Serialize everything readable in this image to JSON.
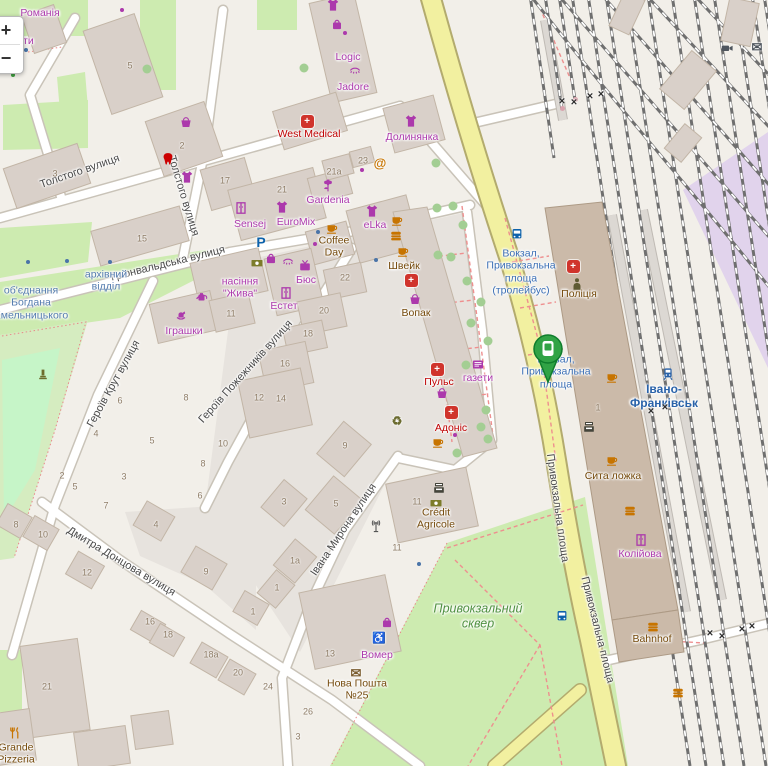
{
  "app": {
    "title": "OpenStreetMap city map — railway station area"
  },
  "controls": {
    "zoom_in": "+",
    "zoom_out": "−"
  },
  "marker": {
    "name": "selected-transit-stop",
    "color": "#31a345"
  },
  "map": {
    "streets": [
      {
        "t": "Толстого вулиця",
        "x": 80,
        "y": 172,
        "r": -19,
        "n": "street-tolstoho"
      },
      {
        "t": "Толстого вулиця",
        "x": 183,
        "y": 196,
        "r": 73,
        "n": "street-tolstoho-2"
      },
      {
        "t": "Грюнвальдська вулиця",
        "x": 168,
        "y": 264,
        "r": -14,
        "n": "street-hriunvaldska"
      },
      {
        "t": "Героїв Крут вулиця",
        "x": 114,
        "y": 384,
        "r": -61,
        "n": "street-heroiv-krut"
      },
      {
        "t": "Героїв Пожежників вулиця",
        "x": 246,
        "y": 372,
        "r": -48,
        "n": "street-heroiv-pozhezhnykiv"
      },
      {
        "t": "Дмитра Донцова вулиця",
        "x": 121,
        "y": 562,
        "r": 31,
        "n": "street-dmytra-dontsova"
      },
      {
        "t": "Івана Мирона вулиця",
        "x": 344,
        "y": 530,
        "r": -56,
        "n": "street-ivana-myrona"
      },
      {
        "t": "Привокзальна площа",
        "x": 557,
        "y": 508,
        "r": 82,
        "n": "street-pryvokzalna-1"
      },
      {
        "t": "Привокзальна площа",
        "x": 597,
        "y": 630,
        "r": 76,
        "n": "street-pryvokzalna-2"
      }
    ],
    "stops": [
      {
        "t": "Вокзал,\nПривокзальна\nплоща\n(тролейбус)",
        "x": 521,
        "y": 272,
        "k": "stop",
        "n": "stop-vokzal-trolleybus"
      },
      {
        "t": "Вокзал,\nПривокзальна\nплоща",
        "x": 556,
        "y": 372,
        "k": "stop",
        "n": "stop-vokzal-square"
      },
      {
        "t": "об'єднання\nБогдана\nХмельницького",
        "x": 31,
        "y": 303,
        "k": "busstop",
        "n": "stop-obiednannia"
      },
      {
        "t": "архівний\nвідділ",
        "x": 106,
        "y": 281,
        "k": "busstop",
        "n": "stop-arkhivnyi-viddil"
      },
      {
        "t": "Івано-\nФранківськ",
        "x": 664,
        "y": 396,
        "k": "station",
        "n": "station-ivano-frankivsk"
      }
    ],
    "pois": [
      {
        "t": "Романія",
        "x": 40,
        "y": 13,
        "k": "shop",
        "n": "poi-romaniia"
      },
      {
        "t": "кти",
        "x": 26,
        "y": 41,
        "k": "shop",
        "n": "poi-produkty-fragment"
      },
      {
        "t": "Logic",
        "x": 348,
        "y": 57,
        "k": "shop",
        "n": "poi-logic"
      },
      {
        "t": "Jadore",
        "x": 353,
        "y": 87,
        "k": "shop",
        "n": "poi-jadore"
      },
      {
        "t": "Долинянка",
        "x": 412,
        "y": 137,
        "k": "shop",
        "n": "poi-dolynianka"
      },
      {
        "t": "Sensej",
        "x": 250,
        "y": 224,
        "k": "shop",
        "n": "poi-sensej"
      },
      {
        "t": "EuroMix",
        "x": 296,
        "y": 222,
        "k": "shop",
        "n": "poi-euromix"
      },
      {
        "t": "Gardenia",
        "x": 328,
        "y": 200,
        "k": "shop",
        "n": "poi-gardenia"
      },
      {
        "t": "eLka",
        "x": 375,
        "y": 225,
        "k": "shop",
        "n": "poi-elka"
      },
      {
        "t": "насіння\n\"Жива\"",
        "x": 240,
        "y": 288,
        "k": "shop",
        "n": "poi-nasinnia-zhyva"
      },
      {
        "t": "Бюс",
        "x": 306,
        "y": 280,
        "k": "shop",
        "n": "poi-bius"
      },
      {
        "t": "Естет",
        "x": 284,
        "y": 306,
        "k": "shop",
        "n": "poi-estet"
      },
      {
        "t": "Іграшки",
        "x": 184,
        "y": 331,
        "k": "shop",
        "n": "poi-ihrashky"
      },
      {
        "t": "газети",
        "x": 478,
        "y": 378,
        "k": "shop",
        "n": "poi-hazety"
      },
      {
        "t": "Колійова",
        "x": 640,
        "y": 554,
        "k": "shop",
        "n": "poi-koliiova"
      },
      {
        "t": "Вомер",
        "x": 377,
        "y": 655,
        "k": "shop",
        "n": "poi-vomer"
      },
      {
        "t": "Coffee\nDay",
        "x": 334,
        "y": 247,
        "k": "amenity",
        "n": "poi-coffee-day"
      },
      {
        "t": "Швейк",
        "x": 404,
        "y": 266,
        "k": "amenity",
        "n": "poi-shveik"
      },
      {
        "t": "Вопак",
        "x": 416,
        "y": 313,
        "k": "amenity",
        "n": "poi-vopak"
      },
      {
        "t": "Поліція",
        "x": 579,
        "y": 294,
        "k": "amenity",
        "n": "poi-politsiia"
      },
      {
        "t": "Сита ложка",
        "x": 613,
        "y": 476,
        "k": "amenity",
        "n": "poi-syta-lozhka"
      },
      {
        "t": "Bahnhof",
        "x": 652,
        "y": 639,
        "k": "amenity",
        "n": "poi-bahnhof"
      },
      {
        "t": "Crédit\nAgricole",
        "x": 436,
        "y": 519,
        "k": "amenity",
        "n": "poi-credit-agricole"
      },
      {
        "t": "Нова Пошта\n№25",
        "x": 357,
        "y": 690,
        "k": "amenity",
        "n": "poi-nova-poshta-25"
      },
      {
        "t": "Grande\nPizzeria",
        "x": 16,
        "y": 754,
        "k": "amenity",
        "n": "poi-grande-pizzeria"
      },
      {
        "t": "West Medical",
        "x": 309,
        "y": 134,
        "k": "health",
        "n": "poi-west-medical"
      },
      {
        "t": "Пульс",
        "x": 439,
        "y": 382,
        "k": "health",
        "n": "poi-puls"
      },
      {
        "t": "Адоніс",
        "x": 451,
        "y": 428,
        "k": "health",
        "n": "poi-adonis"
      },
      {
        "t": "Привокзальний\nсквер",
        "x": 478,
        "y": 616,
        "k": "parklbl",
        "n": "area-pryvokzalnyi-skver"
      }
    ],
    "housenumbers": [
      {
        "t": "5",
        "x": 130,
        "y": 66
      },
      {
        "t": "3",
        "x": 55,
        "y": 174
      },
      {
        "t": "2",
        "x": 182,
        "y": 146
      },
      {
        "t": "17",
        "x": 225,
        "y": 181
      },
      {
        "t": "15",
        "x": 142,
        "y": 239
      },
      {
        "t": "21",
        "x": 282,
        "y": 190
      },
      {
        "t": "21a",
        "x": 334,
        "y": 172
      },
      {
        "t": "23",
        "x": 363,
        "y": 161
      },
      {
        "t": "22",
        "x": 345,
        "y": 278
      },
      {
        "t": "20",
        "x": 324,
        "y": 311
      },
      {
        "t": "18",
        "x": 308,
        "y": 334
      },
      {
        "t": "16",
        "x": 285,
        "y": 364
      },
      {
        "t": "14",
        "x": 281,
        "y": 399
      },
      {
        "t": "12",
        "x": 259,
        "y": 398
      },
      {
        "t": "11",
        "x": 231,
        "y": 314
      },
      {
        "t": "8",
        "x": 186,
        "y": 398
      },
      {
        "t": "6",
        "x": 120,
        "y": 401
      },
      {
        "t": "5",
        "x": 152,
        "y": 441
      },
      {
        "t": "4",
        "x": 96,
        "y": 434
      },
      {
        "t": "10",
        "x": 223,
        "y": 444
      },
      {
        "t": "8",
        "x": 203,
        "y": 464
      },
      {
        "t": "3",
        "x": 124,
        "y": 477
      },
      {
        "t": "2",
        "x": 62,
        "y": 476
      },
      {
        "t": "5",
        "x": 75,
        "y": 487
      },
      {
        "t": "6",
        "x": 200,
        "y": 496
      },
      {
        "t": "7",
        "x": 106,
        "y": 506
      },
      {
        "t": "9",
        "x": 345,
        "y": 446
      },
      {
        "t": "3",
        "x": 284,
        "y": 502
      },
      {
        "t": "5",
        "x": 336,
        "y": 504
      },
      {
        "t": "1a",
        "x": 295,
        "y": 561
      },
      {
        "t": "1",
        "x": 277,
        "y": 588
      },
      {
        "t": "11",
        "x": 417,
        "y": 502
      },
      {
        "t": "11",
        "x": 397,
        "y": 548
      },
      {
        "t": "13",
        "x": 330,
        "y": 654
      },
      {
        "t": "24",
        "x": 268,
        "y": 687
      },
      {
        "t": "26",
        "x": 308,
        "y": 712
      },
      {
        "t": "3",
        "x": 298,
        "y": 737
      },
      {
        "t": "8",
        "x": 16,
        "y": 525
      },
      {
        "t": "10",
        "x": 43,
        "y": 535
      },
      {
        "t": "12",
        "x": 87,
        "y": 573
      },
      {
        "t": "4",
        "x": 156,
        "y": 525
      },
      {
        "t": "9",
        "x": 206,
        "y": 572
      },
      {
        "t": "1",
        "x": 253,
        "y": 612
      },
      {
        "t": "16",
        "x": 150,
        "y": 622
      },
      {
        "t": "18",
        "x": 168,
        "y": 635
      },
      {
        "t": "18a",
        "x": 211,
        "y": 655
      },
      {
        "t": "20",
        "x": 238,
        "y": 673
      },
      {
        "t": "21",
        "x": 47,
        "y": 687
      },
      {
        "t": "1",
        "x": 598,
        "y": 408
      }
    ],
    "icons": [
      {
        "s": "bus",
        "x": 517,
        "y": 234,
        "c": "#0d62ab",
        "n": "bus-stop-icon"
      },
      {
        "s": "bus",
        "x": 562,
        "y": 616,
        "c": "#0d62ab",
        "n": "bus-stop-icon"
      },
      {
        "s": "train",
        "x": 668,
        "y": 374,
        "c": "#2962a9",
        "n": "railway-station-icon"
      },
      {
        "ch": "P",
        "x": 261,
        "y": 242,
        "c": "#0d62ab",
        "fs": 14,
        "n": "parking-icon"
      },
      {
        "s": "tshirt",
        "x": 411,
        "y": 121,
        "c": "#ac39ac",
        "n": "clothes-shop-icon"
      },
      {
        "s": "tshirt",
        "x": 282,
        "y": 207,
        "c": "#ac39ac",
        "n": "clothes-shop-icon"
      },
      {
        "s": "tshirt",
        "x": 372,
        "y": 211,
        "c": "#ac39ac",
        "n": "clothes-shop-icon"
      },
      {
        "s": "tshirt",
        "x": 333,
        "y": 5,
        "c": "#ac39ac",
        "n": "clothes-shop-icon"
      },
      {
        "s": "tshirt",
        "x": 187,
        "y": 177,
        "c": "#ac39ac",
        "n": "clothes-shop-icon"
      },
      {
        "s": "wardrobe",
        "x": 241,
        "y": 208,
        "c": "#ac39ac",
        "n": "furniture-shop-icon"
      },
      {
        "s": "wardrobe",
        "x": 641,
        "y": 540,
        "c": "#ac39ac",
        "n": "furniture-shop-icon"
      },
      {
        "s": "wardrobe",
        "x": 286,
        "y": 293,
        "c": "#ac39ac",
        "n": "furniture-shop-icon"
      },
      {
        "s": "flower",
        "x": 328,
        "y": 186,
        "c": "#ac39ac",
        "n": "florist-icon"
      },
      {
        "s": "basket",
        "x": 186,
        "y": 122,
        "c": "#ac39ac",
        "n": "supermarket-icon"
      },
      {
        "s": "basket",
        "x": 415,
        "y": 299,
        "c": "#ac39ac",
        "n": "supermarket-icon"
      },
      {
        "s": "basket",
        "x": 442,
        "y": 393,
        "c": "#ac39ac",
        "n": "supermarket-icon"
      },
      {
        "s": "tv",
        "x": 305,
        "y": 266,
        "c": "#ac39ac",
        "n": "electronics-shop-icon"
      },
      {
        "s": "can",
        "x": 202,
        "y": 296,
        "c": "#ac39ac",
        "n": "garden-shop-icon"
      },
      {
        "s": "news",
        "x": 478,
        "y": 364,
        "c": "#ac39ac",
        "n": "newsagent-icon"
      },
      {
        "s": "bag",
        "x": 271,
        "y": 258,
        "c": "#ac39ac",
        "n": "bag-shop-icon"
      },
      {
        "s": "bag",
        "x": 337,
        "y": 24,
        "c": "#ac39ac",
        "n": "bag-shop-icon"
      },
      {
        "s": "bag",
        "x": 387,
        "y": 622,
        "c": "#ac39ac",
        "n": "bag-shop-icon"
      },
      {
        "s": "lash",
        "x": 288,
        "y": 261,
        "c": "#ac39ac",
        "n": "beauty-shop-icon"
      },
      {
        "s": "lash",
        "x": 355,
        "y": 70,
        "c": "#ac39ac",
        "n": "beauty-shop-icon"
      },
      {
        "s": "horse",
        "x": 181,
        "y": 315,
        "c": "#ac39ac",
        "n": "toy-shop-icon"
      },
      {
        "ch": "♿",
        "x": 379,
        "y": 639,
        "c": "#ac39ac",
        "fs": 11,
        "n": "wheelchair-icon"
      },
      {
        "s": "cup",
        "x": 332,
        "y": 228,
        "c": "#c77400",
        "n": "cafe-icon"
      },
      {
        "s": "cup",
        "x": 397,
        "y": 220,
        "c": "#c77400",
        "n": "cafe-icon"
      },
      {
        "s": "cup",
        "x": 403,
        "y": 251,
        "c": "#c77400",
        "n": "cafe-icon"
      },
      {
        "s": "cup",
        "x": 612,
        "y": 377,
        "c": "#c77400",
        "n": "cafe-icon"
      },
      {
        "s": "cup",
        "x": 612,
        "y": 460,
        "c": "#c77400",
        "n": "cafe-icon"
      },
      {
        "s": "cup",
        "x": 438,
        "y": 442,
        "c": "#c77400",
        "n": "cafe-icon"
      },
      {
        "s": "burger",
        "x": 396,
        "y": 236,
        "c": "#c77400",
        "n": "fast-food-icon"
      },
      {
        "s": "burger",
        "x": 630,
        "y": 511,
        "c": "#c77400",
        "n": "fast-food-icon"
      },
      {
        "s": "burger",
        "x": 653,
        "y": 627,
        "c": "#c77400",
        "n": "fast-food-icon"
      },
      {
        "s": "burger",
        "x": 678,
        "y": 693,
        "c": "#c77400",
        "n": "fast-food-icon"
      },
      {
        "ch": "@",
        "x": 380,
        "y": 163,
        "c": "#c77400",
        "fs": 13,
        "n": "internet-cafe-icon"
      },
      {
        "s": "fork",
        "x": 15,
        "y": 733,
        "c": "#c77400",
        "n": "restaurant-icon"
      },
      {
        "s": "atm",
        "x": 439,
        "y": 488,
        "c": "#44443a",
        "n": "atm-icon"
      },
      {
        "s": "atm",
        "x": 589,
        "y": 427,
        "c": "#44443a",
        "n": "atm-icon"
      },
      {
        "s": "note",
        "x": 436,
        "y": 503,
        "c": "#7c7c2a",
        "n": "bank-icon"
      },
      {
        "s": "note",
        "x": 257,
        "y": 263,
        "c": "#7c7c2a",
        "n": "money-exchange-icon"
      },
      {
        "ch": "✉",
        "x": 356,
        "y": 673,
        "c": "#7a5c2e",
        "fs": 13,
        "n": "post-office-icon"
      },
      {
        "ch": "✉",
        "x": 757,
        "y": 47,
        "c": "#4f565e",
        "fs": 13,
        "n": "post-box-icon"
      },
      {
        "s": "camera",
        "x": 727,
        "y": 48,
        "c": "#4f565e",
        "n": "video-icon"
      },
      {
        "s": "person",
        "x": 577,
        "y": 284,
        "c": "#5f5a33",
        "n": "police-icon"
      },
      {
        "s": "memorial",
        "x": 43,
        "y": 374,
        "c": "#6d6d2d",
        "n": "memorial-icon"
      },
      {
        "s": "antenna",
        "x": 376,
        "y": 526,
        "c": "#555555",
        "n": "antenna-icon"
      },
      {
        "ch": "♻",
        "x": 397,
        "y": 421,
        "c": "#6b6b2f",
        "fs": 12,
        "n": "recycling-icon"
      },
      {
        "s": "tooth",
        "x": 168,
        "y": 159,
        "c": "#cc0000",
        "n": "dentist-icon"
      },
      {
        "m": 1,
        "x": 307,
        "y": 121,
        "n": "clinic-icon"
      },
      {
        "m": 1,
        "x": 411,
        "y": 280,
        "n": "pharmacy-icon"
      },
      {
        "m": 1,
        "x": 437,
        "y": 369,
        "n": "pharmacy-icon"
      },
      {
        "m": 1,
        "x": 451,
        "y": 412,
        "n": "pharmacy-icon"
      },
      {
        "m": 1,
        "x": 573,
        "y": 266,
        "n": "hospital-icon"
      },
      {
        "d": 4,
        "x": 26,
        "y": 50,
        "c": "#4a74a8",
        "n": "poi-dot"
      },
      {
        "d": 4,
        "x": 318,
        "y": 232,
        "c": "#4a74a8",
        "n": "poi-dot"
      },
      {
        "d": 4,
        "x": 376,
        "y": 260,
        "c": "#4a74a8",
        "n": "poi-dot"
      },
      {
        "d": 4,
        "x": 419,
        "y": 564,
        "c": "#4a74a8",
        "n": "poi-dot"
      },
      {
        "d": 4,
        "x": 28,
        "y": 262,
        "c": "#4a74a8",
        "n": "bus-stop-dot"
      },
      {
        "d": 4,
        "x": 67,
        "y": 261,
        "c": "#4a74a8",
        "n": "bus-stop-dot"
      },
      {
        "d": 4,
        "x": 110,
        "y": 262,
        "c": "#4a74a8",
        "n": "bus-stop-dot"
      },
      {
        "d": 4,
        "x": 345,
        "y": 33,
        "c": "#ac39ac",
        "n": "shop-dot"
      },
      {
        "d": 4,
        "x": 362,
        "y": 170,
        "c": "#ac39ac",
        "n": "shop-dot"
      },
      {
        "d": 4,
        "x": 315,
        "y": 244,
        "c": "#ac39ac",
        "n": "shop-dot"
      },
      {
        "d": 4,
        "x": 455,
        "y": 435,
        "c": "#ac39ac",
        "n": "shop-dot"
      },
      {
        "d": 4,
        "x": 122,
        "y": 10,
        "c": "#ac39ac",
        "n": "shop-dot"
      },
      {
        "d": 4,
        "x": 6,
        "y": 70,
        "c": "#3f9e3f",
        "n": "playground-icon"
      },
      {
        "d": 4,
        "x": 13,
        "y": 75,
        "c": "#3f9e3f",
        "n": "playground-icon"
      },
      {
        "d": 5,
        "x": 562,
        "y": 108,
        "c": "#d9a3ad",
        "n": "buffer-stop-icon"
      },
      {
        "d": 5,
        "x": 575,
        "y": 99,
        "c": "#d9a3ad",
        "n": "buffer-stop-icon"
      },
      {
        "ch": "×",
        "x": 562,
        "y": 102,
        "c": "#2b2b2b",
        "fs": 11,
        "n": "level-crossing-icon"
      },
      {
        "ch": "×",
        "x": 574,
        "y": 103,
        "c": "#2b2b2b",
        "fs": 11,
        "n": "level-crossing-icon"
      },
      {
        "ch": "×",
        "x": 590,
        "y": 97,
        "c": "#2b2b2b",
        "fs": 11,
        "n": "level-crossing-icon"
      },
      {
        "ch": "×",
        "x": 601,
        "y": 95,
        "c": "#2b2b2b",
        "fs": 11,
        "n": "level-crossing-icon"
      },
      {
        "ch": "×",
        "x": 651,
        "y": 412,
        "c": "#2b2b2b",
        "fs": 11,
        "n": "level-crossing-icon"
      },
      {
        "ch": "×",
        "x": 665,
        "y": 408,
        "c": "#2b2b2b",
        "fs": 11,
        "n": "level-crossing-icon"
      },
      {
        "ch": "×",
        "x": 710,
        "y": 634,
        "c": "#2b2b2b",
        "fs": 11,
        "n": "level-crossing-icon"
      },
      {
        "ch": "×",
        "x": 722,
        "y": 637,
        "c": "#2b2b2b",
        "fs": 11,
        "n": "level-crossing-icon"
      },
      {
        "ch": "×",
        "x": 742,
        "y": 630,
        "c": "#2b2b2b",
        "fs": 11,
        "n": "level-crossing-icon"
      },
      {
        "ch": "×",
        "x": 752,
        "y": 627,
        "c": "#2b2b2b",
        "fs": 11,
        "n": "level-crossing-icon"
      }
    ]
  }
}
